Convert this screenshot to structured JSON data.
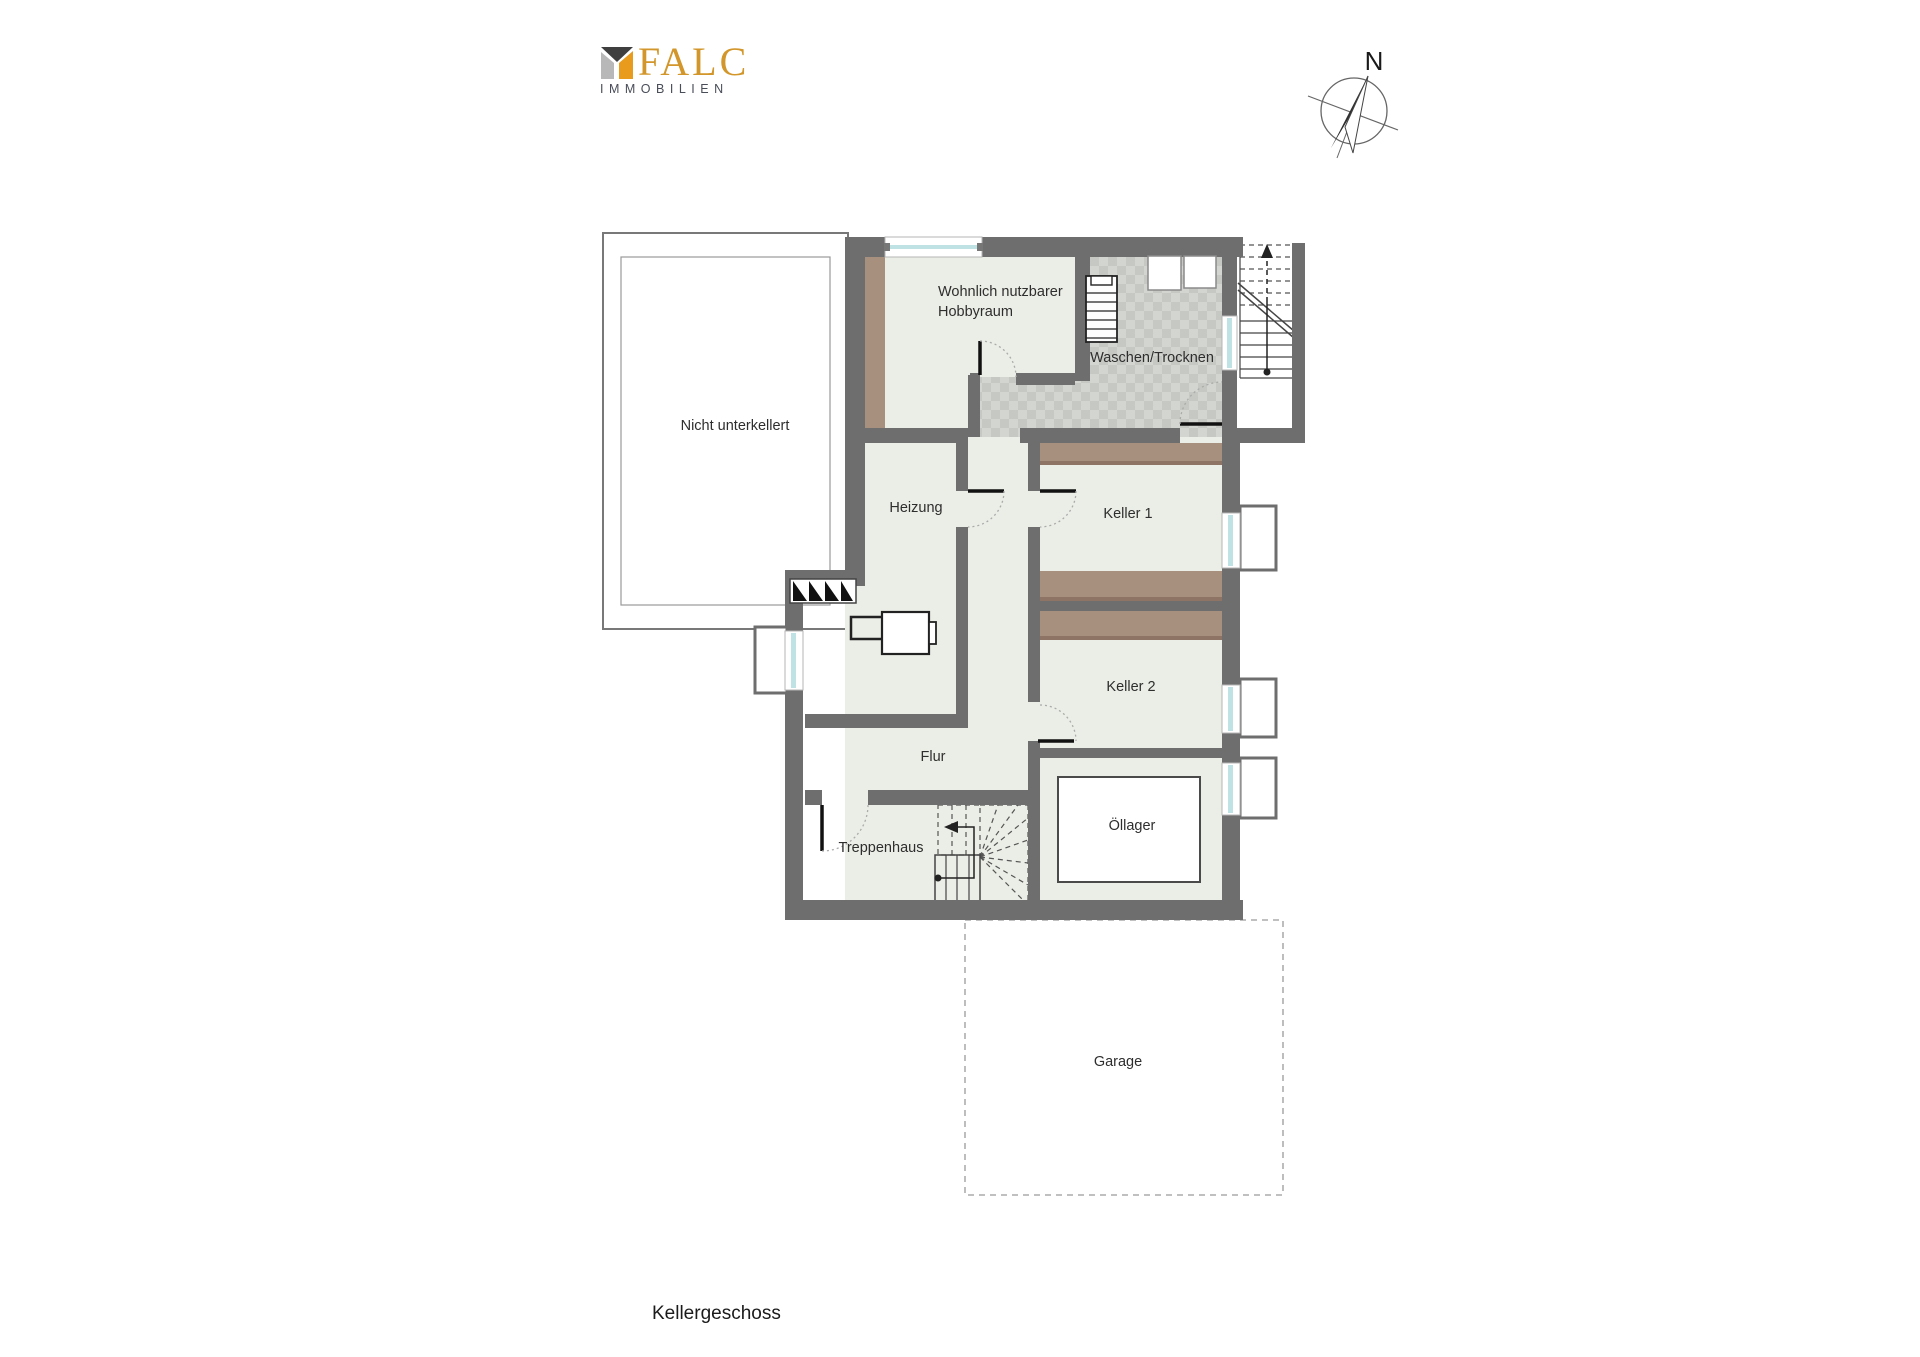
{
  "branding": {
    "name": "FALC",
    "subtitle": "IMMOBILIEN"
  },
  "compass": {
    "north_label": "N"
  },
  "plan": {
    "floor_label": "Kellergeschoss",
    "rooms": {
      "nicht_unterkellert": "Nicht unterkellert",
      "hobbyraum_line1": "Wohnlich nutzbarer",
      "hobbyraum_line2": "Hobbyraum",
      "waschen_trocknen": "Waschen/Trocknen",
      "heizung": "Heizung",
      "keller_1": "Keller 1",
      "keller_2": "Keller 2",
      "flur": "Flur",
      "treppenhaus": "Treppenhaus",
      "oellager": "Öllager",
      "garage": "Garage"
    }
  },
  "colors": {
    "wall": "#6e6e6e",
    "floor": "#ebeee6",
    "tile_dark": "#c6c8c3",
    "tile_light": "#d3d5d0",
    "wood_shelf": "#a8907e",
    "window_glass": "#bfe2e5",
    "logo_gold": "#d2962a",
    "logo_gray": "#494d58"
  }
}
